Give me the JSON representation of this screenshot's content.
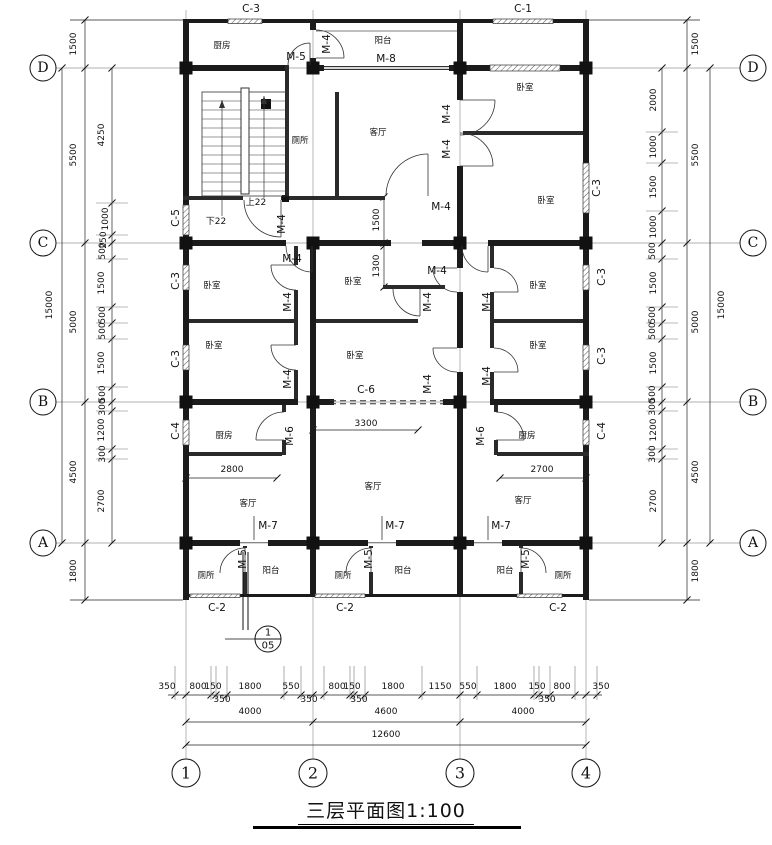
{
  "drawing_title": {
    "text": "三层平面图",
    "scale": "1:100",
    "full": "三层平面图1:100"
  },
  "grid": {
    "row_labels": [
      {
        "t": "D",
        "y": 68
      },
      {
        "t": "C",
        "y": 243
      },
      {
        "t": "B",
        "y": 402
      },
      {
        "t": "A",
        "y": 543
      }
    ],
    "col_labels": [
      {
        "t": "1",
        "x": 186
      },
      {
        "t": "2",
        "x": 313
      },
      {
        "t": "3",
        "x": 460
      },
      {
        "t": "4",
        "x": 586
      }
    ]
  },
  "rooms": [
    {
      "t": "厨房",
      "x": 222,
      "y": 46
    },
    {
      "t": "阳台",
      "x": 383,
      "y": 41
    },
    {
      "t": "卧室",
      "x": 525,
      "y": 88
    },
    {
      "t": "厕所",
      "x": 300,
      "y": 141
    },
    {
      "t": "客厅",
      "x": 378,
      "y": 133
    },
    {
      "t": "卧室",
      "x": 546,
      "y": 201
    },
    {
      "t": "卧室",
      "x": 212,
      "y": 286
    },
    {
      "t": "卧室",
      "x": 214,
      "y": 346
    },
    {
      "t": "卧室",
      "x": 353,
      "y": 282
    },
    {
      "t": "卧室",
      "x": 355,
      "y": 356
    },
    {
      "t": "卧室",
      "x": 538,
      "y": 286
    },
    {
      "t": "卧室",
      "x": 538,
      "y": 346
    },
    {
      "t": "厨房",
      "x": 224,
      "y": 436
    },
    {
      "t": "厨房",
      "x": 527,
      "y": 436
    },
    {
      "t": "客厅",
      "x": 248,
      "y": 504
    },
    {
      "t": "客厅",
      "x": 373,
      "y": 487
    },
    {
      "t": "客厅",
      "x": 523,
      "y": 501
    },
    {
      "t": "厕所",
      "x": 206,
      "y": 576
    },
    {
      "t": "阳台",
      "x": 271,
      "y": 571
    },
    {
      "t": "厕所",
      "x": 343,
      "y": 576
    },
    {
      "t": "阳台",
      "x": 403,
      "y": 571
    },
    {
      "t": "阳台",
      "x": 505,
      "y": 571
    },
    {
      "t": "厕所",
      "x": 563,
      "y": 576
    }
  ],
  "doors": [
    {
      "t": "M-5",
      "x": 296,
      "y": 57
    },
    {
      "t": "M-8",
      "x": 386,
      "y": 59
    },
    {
      "t": "M-4",
      "x": 327,
      "y": 44,
      "r": -90
    },
    {
      "t": "M-4",
      "x": 447,
      "y": 114,
      "r": -90
    },
    {
      "t": "M-4",
      "x": 447,
      "y": 149,
      "r": -90
    },
    {
      "t": "M-4",
      "x": 441,
      "y": 207
    },
    {
      "t": "M-4",
      "x": 282,
      "y": 224,
      "r": -90
    },
    {
      "t": "M-4",
      "x": 292,
      "y": 259
    },
    {
      "t": "M-4",
      "x": 288,
      "y": 302,
      "r": -90
    },
    {
      "t": "M-4",
      "x": 288,
      "y": 379,
      "r": -90
    },
    {
      "t": "M-4",
      "x": 437,
      "y": 271
    },
    {
      "t": "M-4",
      "x": 428,
      "y": 302,
      "r": -90
    },
    {
      "t": "M-4",
      "x": 487,
      "y": 302,
      "r": -90
    },
    {
      "t": "M-4",
      "x": 428,
      "y": 384,
      "r": -90
    },
    {
      "t": "M-4",
      "x": 487,
      "y": 376,
      "r": -90
    },
    {
      "t": "M-6",
      "x": 290,
      "y": 436,
      "r": -90
    },
    {
      "t": "M-6",
      "x": 481,
      "y": 436,
      "r": -90
    },
    {
      "t": "M-7",
      "x": 268,
      "y": 526
    },
    {
      "t": "M-7",
      "x": 395,
      "y": 526
    },
    {
      "t": "M-7",
      "x": 501,
      "y": 526
    },
    {
      "t": "M-5",
      "x": 243,
      "y": 559,
      "r": -90
    },
    {
      "t": "M-5",
      "x": 369,
      "y": 559,
      "r": -90
    },
    {
      "t": "M-5",
      "x": 526,
      "y": 559,
      "r": -90
    }
  ],
  "windows": [
    {
      "t": "C-3",
      "x": 251,
      "y": 9
    },
    {
      "t": "C-1",
      "x": 523,
      "y": 9
    },
    {
      "t": "C-5",
      "x": 176,
      "y": 218,
      "r": -90
    },
    {
      "t": "C-3",
      "x": 176,
      "y": 281,
      "r": -90
    },
    {
      "t": "C-3",
      "x": 176,
      "y": 359,
      "r": -90
    },
    {
      "t": "C-4",
      "x": 176,
      "y": 431,
      "r": -90
    },
    {
      "t": "C-3",
      "x": 597,
      "y": 188,
      "r": -90
    },
    {
      "t": "C-3",
      "x": 602,
      "y": 277,
      "r": -90
    },
    {
      "t": "C-3",
      "x": 602,
      "y": 356,
      "r": -90
    },
    {
      "t": "C-4",
      "x": 602,
      "y": 431,
      "r": -90
    },
    {
      "t": "C-6",
      "x": 366,
      "y": 390
    },
    {
      "t": "C-2",
      "x": 217,
      "y": 608
    },
    {
      "t": "C-2",
      "x": 345,
      "y": 608
    },
    {
      "t": "C-2",
      "x": 558,
      "y": 608
    }
  ],
  "stair": [
    {
      "t": "下22",
      "x": 216,
      "y": 222
    },
    {
      "t": "上22",
      "x": 256,
      "y": 203
    }
  ],
  "dims": {
    "left": [
      {
        "t": "15000",
        "x": 50,
        "y": 305,
        "r": -90
      },
      {
        "t": "1500",
        "x": 74,
        "y": 44,
        "r": -90
      },
      {
        "t": "5500",
        "x": 74,
        "y": 155,
        "r": -90
      },
      {
        "t": "5000",
        "x": 74,
        "y": 322,
        "r": -90
      },
      {
        "t": "4500",
        "x": 74,
        "y": 472,
        "r": -90
      },
      {
        "t": "1800",
        "x": 74,
        "y": 571,
        "r": -90
      },
      {
        "t": "4250",
        "x": 102,
        "y": 135,
        "r": -90
      },
      {
        "t": "1000",
        "x": 106,
        "y": 219,
        "r": -90
      },
      {
        "t": "250",
        "x": 104,
        "y": 240,
        "r": -90
      },
      {
        "t": "500",
        "x": 103,
        "y": 251,
        "r": -90
      },
      {
        "t": "1500",
        "x": 102,
        "y": 283,
        "r": -90
      },
      {
        "t": "500",
        "x": 103,
        "y": 315,
        "r": -90
      },
      {
        "t": "500",
        "x": 103,
        "y": 331,
        "r": -90
      },
      {
        "t": "1500",
        "x": 102,
        "y": 363,
        "r": -90
      },
      {
        "t": "500",
        "x": 103,
        "y": 394,
        "r": -90
      },
      {
        "t": "300",
        "x": 103,
        "y": 407,
        "r": -90
      },
      {
        "t": "1200",
        "x": 102,
        "y": 430,
        "r": -90
      },
      {
        "t": "300",
        "x": 103,
        "y": 454,
        "r": -90
      },
      {
        "t": "2700",
        "x": 102,
        "y": 501,
        "r": -90
      }
    ],
    "right": [
      {
        "t": "15000",
        "x": 722,
        "y": 305,
        "r": -90
      },
      {
        "t": "1500",
        "x": 696,
        "y": 44,
        "r": -90
      },
      {
        "t": "5500",
        "x": 696,
        "y": 155,
        "r": -90
      },
      {
        "t": "5000",
        "x": 696,
        "y": 322,
        "r": -90
      },
      {
        "t": "4500",
        "x": 696,
        "y": 472,
        "r": -90
      },
      {
        "t": "1800",
        "x": 696,
        "y": 571,
        "r": -90
      },
      {
        "t": "2000",
        "x": 654,
        "y": 100,
        "r": -90
      },
      {
        "t": "1000",
        "x": 654,
        "y": 147,
        "r": -90
      },
      {
        "t": "1500",
        "x": 654,
        "y": 187,
        "r": -90
      },
      {
        "t": "1000",
        "x": 654,
        "y": 227,
        "r": -90
      },
      {
        "t": "500",
        "x": 653,
        "y": 251,
        "r": -90
      },
      {
        "t": "1500",
        "x": 654,
        "y": 283,
        "r": -90
      },
      {
        "t": "500",
        "x": 653,
        "y": 315,
        "r": -90
      },
      {
        "t": "500",
        "x": 653,
        "y": 331,
        "r": -90
      },
      {
        "t": "1500",
        "x": 654,
        "y": 363,
        "r": -90
      },
      {
        "t": "500",
        "x": 653,
        "y": 394,
        "r": -90
      },
      {
        "t": "300",
        "x": 653,
        "y": 407,
        "r": -90
      },
      {
        "t": "1200",
        "x": 654,
        "y": 430,
        "r": -90
      },
      {
        "t": "300",
        "x": 653,
        "y": 454,
        "r": -90
      },
      {
        "t": "2700",
        "x": 654,
        "y": 501,
        "r": -90
      }
    ],
    "bottom": [
      {
        "t": "350",
        "x": 167,
        "y": 687
      },
      {
        "t": "800",
        "x": 198,
        "y": 687
      },
      {
        "t": "150",
        "x": 213,
        "y": 687
      },
      {
        "t": "1800",
        "x": 250,
        "y": 687
      },
      {
        "t": "550",
        "x": 291,
        "y": 687
      },
      {
        "t": "800",
        "x": 337,
        "y": 687
      },
      {
        "t": "150",
        "x": 352,
        "y": 687
      },
      {
        "t": "1800",
        "x": 393,
        "y": 687
      },
      {
        "t": "1150",
        "x": 440,
        "y": 687
      },
      {
        "t": "550",
        "x": 468,
        "y": 687
      },
      {
        "t": "1800",
        "x": 505,
        "y": 687
      },
      {
        "t": "150",
        "x": 537,
        "y": 687
      },
      {
        "t": "800",
        "x": 562,
        "y": 687
      },
      {
        "t": "350",
        "x": 601,
        "y": 687
      },
      {
        "t": "350",
        "x": 222,
        "y": 700
      },
      {
        "t": "350",
        "x": 309,
        "y": 700
      },
      {
        "t": "350",
        "x": 359,
        "y": 700
      },
      {
        "t": "350",
        "x": 547,
        "y": 700
      },
      {
        "t": "4000",
        "x": 250,
        "y": 712
      },
      {
        "t": "4600",
        "x": 386,
        "y": 712
      },
      {
        "t": "4000",
        "x": 523,
        "y": 712
      },
      {
        "t": "12600",
        "x": 386,
        "y": 735
      }
    ],
    "interior": [
      {
        "t": "1500",
        "x": 377,
        "y": 220,
        "r": -90
      },
      {
        "t": "1300",
        "x": 377,
        "y": 266,
        "r": -90
      },
      {
        "t": "2800",
        "x": 232,
        "y": 470
      },
      {
        "t": "3300",
        "x": 366,
        "y": 424
      },
      {
        "t": "2700",
        "x": 542,
        "y": 470
      }
    ]
  },
  "callout": {
    "num": "1",
    "sheet": "05",
    "x": 268,
    "y": 639
  }
}
